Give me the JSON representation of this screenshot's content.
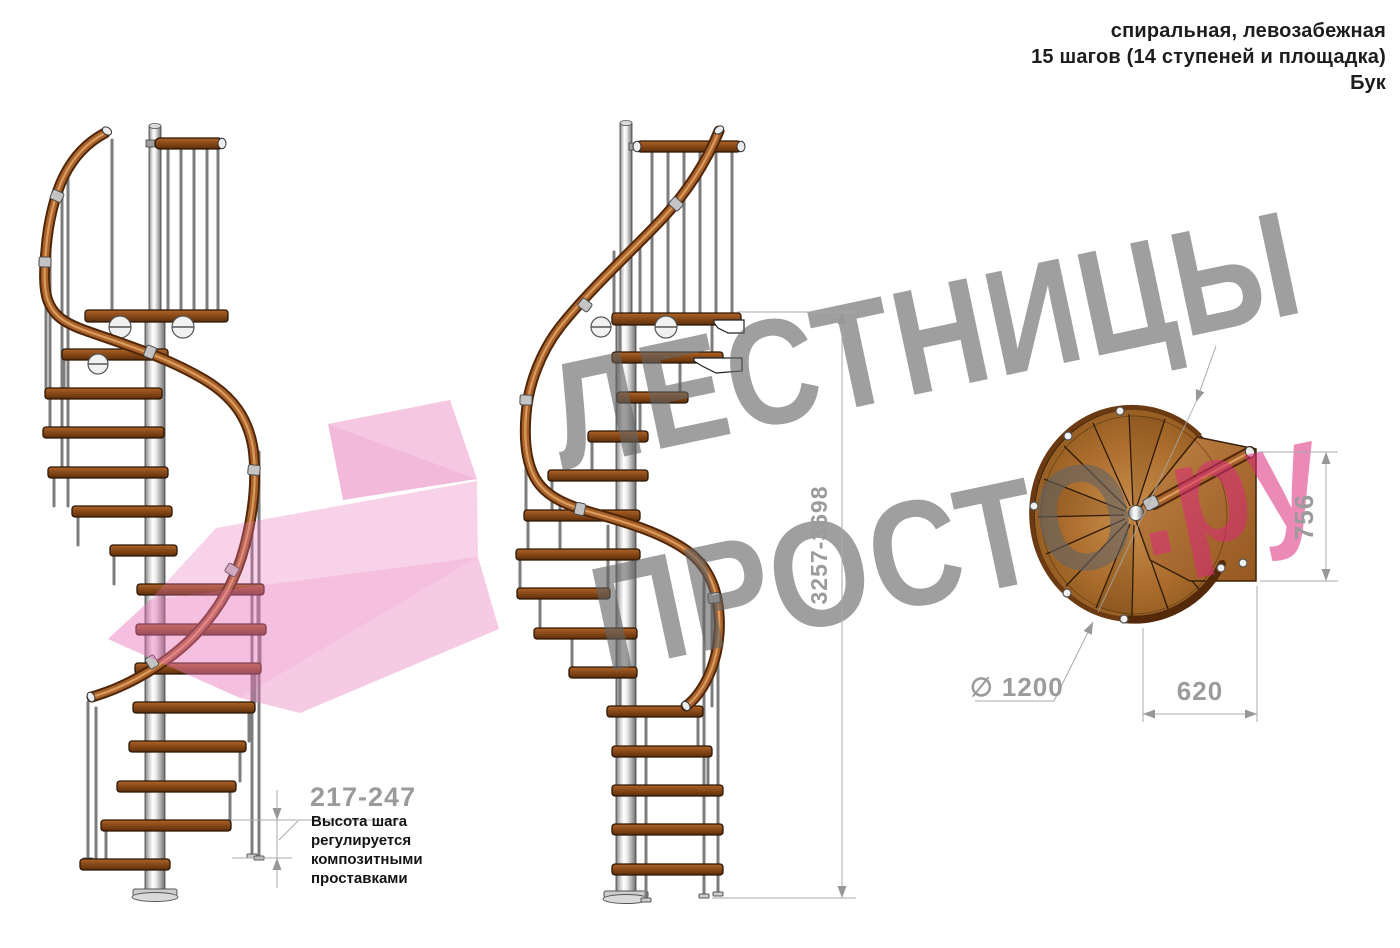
{
  "header": {
    "line1": "спиральная, левозабежная",
    "line2": "15 шагов (14 ступеней и площадка)",
    "line3": "Бук"
  },
  "watermark": {
    "word1": "ЛЕСТНИЦЫ",
    "word2": "ПРОСТО",
    "domain_suffix": ".ру"
  },
  "dimensions": {
    "total_height_range": "3257-3698",
    "step_height_range": "217-247",
    "diameter": "∅ 1200",
    "landing_depth": "620",
    "landing_width": "756"
  },
  "step_note": {
    "line1": "Высота шага",
    "line2": "регулируется",
    "line3": "композитными",
    "line4": "проставками"
  },
  "colors": {
    "wood": "#9a5620",
    "handrail": "#a9622a",
    "metal": "#c7c7c7",
    "dimension_gray": "#9b9b9b",
    "watermark_gray": "#8a8a8a",
    "watermark_pink": "#e268a4"
  }
}
